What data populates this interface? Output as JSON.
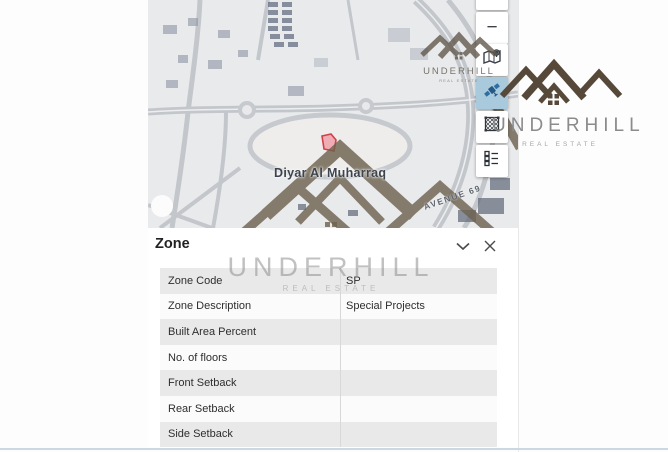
{
  "watermark": {
    "brand": "UNDERHILL",
    "tagline": "REAL ESTATE"
  },
  "map": {
    "place_label": "Diyar Al Muharraq",
    "street_label": "AVENUE 69",
    "zoom_in_label": "+",
    "zoom_out_label": "−",
    "active_basemap": "satellite"
  },
  "panel": {
    "title": "Zone",
    "rows": [
      {
        "label": "Zone Code",
        "value": "SP"
      },
      {
        "label": "Zone Description",
        "value": "Special Projects"
      },
      {
        "label": "Built Area Percent",
        "value": ""
      },
      {
        "label": "No. of floors",
        "value": ""
      },
      {
        "label": "Front Setback",
        "value": ""
      },
      {
        "label": "Rear Setback",
        "value": ""
      },
      {
        "label": "Side Setback",
        "value": ""
      }
    ]
  },
  "colors": {
    "active_button_bg": "#a9c9dc",
    "marker_stroke": "#cf3742",
    "marker_fill": "#f0a9b2",
    "watermark_brown": "#6e6350",
    "row_gray": "#e9e9e9",
    "bottom_edge": "#ccd8e1"
  }
}
